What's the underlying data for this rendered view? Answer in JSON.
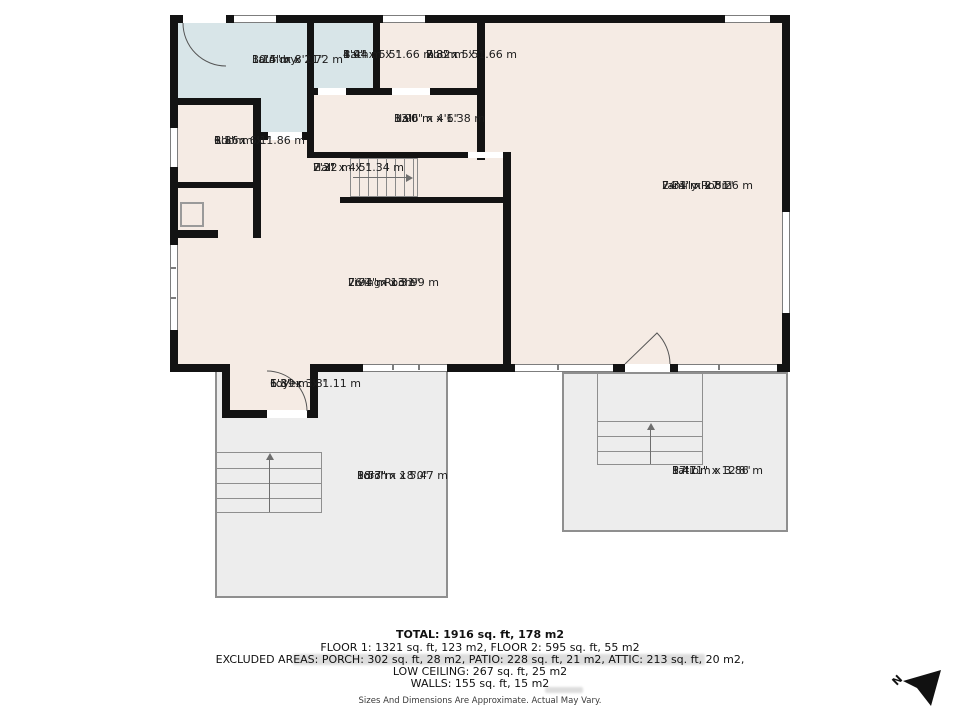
{
  "colors": {
    "wall": "#131313",
    "floor": "#f5ebe4",
    "wet": "#d8e5e8",
    "outdoor": "#ededed",
    "line": "#8f8f8f"
  },
  "rooms": {
    "laundry": {
      "name": "Laundry",
      "imperial": "10'4\" x 8'11\"",
      "metric": "3.15 m x 2.72 m"
    },
    "bath": {
      "name": "Bath",
      "imperial": "4'9\" x 5'5\"",
      "metric": "1.44 m x 1.66 m"
    },
    "room_top": {
      "name": "Room",
      "imperial": "7'8\" x 5'5\"",
      "metric": "2.32 m x 1.66 m"
    },
    "hall_upper": {
      "name": "Hall",
      "imperial": "13'0\" x 4'6\"",
      "metric": "3.96 m x 1.38 m"
    },
    "room_left": {
      "name": "Room",
      "imperial": "6'1\" x 6'1\"",
      "metric": "1.86 m x 1.86 m"
    },
    "hall_lower": {
      "name": "Hall",
      "imperial": "7'3\" x 4'5\"",
      "metric": "2.22 m x 1.34 m"
    },
    "family": {
      "name": "Family Room",
      "imperial": "24'1\" x 27'1\"",
      "metric": "7.34 m x 8.26 m"
    },
    "living": {
      "name": "Living Room",
      "imperial": "26'1\" x 13'1\"",
      "metric": "7.94 m x 3.99 m"
    },
    "foyer": {
      "name": "Foyer",
      "imperial": "6'3\" x 3'8\"",
      "metric": "1.89 m x 1.11 m"
    },
    "porch": {
      "name": "Porch",
      "imperial": "18'3\" x 18'0\"",
      "metric": "5.57 m x 5.47 m"
    },
    "patio": {
      "name": "Patio",
      "imperial": "17'11\" x 12'8\"",
      "metric": "5.47 m x 3.86 m"
    }
  },
  "summary": {
    "total": "TOTAL: 1916 sq. ft, 178 m2",
    "floors": "FLOOR 1: 1321 sq. ft, 123 m2, FLOOR 2: 595 sq. ft, 55 m2",
    "excluded": "EXCLUDED AREAS: PORCH: 302 sq. ft, 28 m2, PATIO: 228 sq. ft, 21 m2, ATTIC: 213 sq. ft, 20 m2,",
    "low_ceiling": "LOW CEILING: 267 sq. ft, 25 m2",
    "walls": "WALLS: 155 sq. ft, 15 m2",
    "disclaimer": "Sizes And Dimensions Are Approximate. Actual May Vary."
  },
  "compass": {
    "label": "N"
  }
}
